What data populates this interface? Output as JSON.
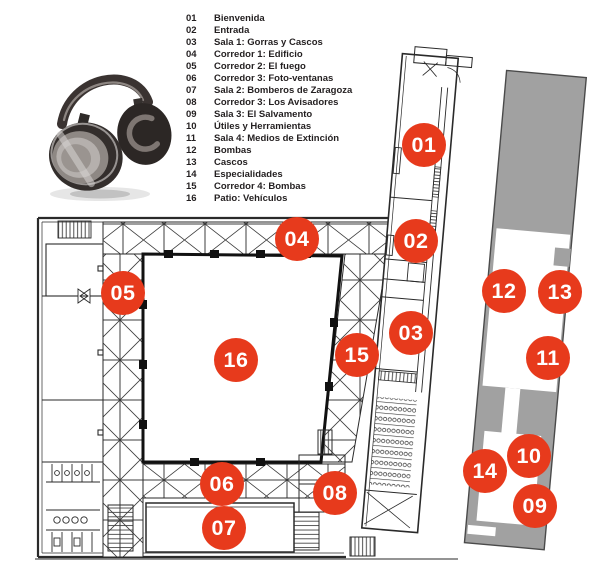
{
  "page": {
    "type": "museum-audioguide-floorplan"
  },
  "legend": {
    "items": [
      {
        "num": "01",
        "label": "Bienvenida"
      },
      {
        "num": "02",
        "label": "Entrada"
      },
      {
        "num": "03",
        "label": "Sala 1: Gorras y Cascos"
      },
      {
        "num": "04",
        "label": "Corredor 1: Edificio"
      },
      {
        "num": "05",
        "label": "Corredor 2: El fuego"
      },
      {
        "num": "06",
        "label": "Corredor 3: Foto-ventanas"
      },
      {
        "num": "07",
        "label": "Sala 2: Bomberos de Zaragoza"
      },
      {
        "num": "08",
        "label": "Corredor 3: Los Avisadores"
      },
      {
        "num": "09",
        "label": "Sala 3: El Salvamento"
      },
      {
        "num": "10",
        "label": "Útiles y Herramientas"
      },
      {
        "num": "11",
        "label": "Sala 4: Medios de Extinción"
      },
      {
        "num": "12",
        "label": "Bombas"
      },
      {
        "num": "13",
        "label": "Cascos"
      },
      {
        "num": "14",
        "label": "Especialidades"
      },
      {
        "num": "15",
        "label": "Corredor 4: Bombas"
      },
      {
        "num": "16",
        "label": "Patio: Vehículos"
      }
    ],
    "text_color": "#231f20"
  },
  "map": {
    "marker_color": "#e73a1c",
    "marker_text_color": "#ffffff",
    "annex_fill": "#a1a1a1",
    "line_color": "#2a2a2a",
    "markers": [
      {
        "num": "01",
        "x": 424,
        "y": 145
      },
      {
        "num": "02",
        "x": 416,
        "y": 241
      },
      {
        "num": "03",
        "x": 411,
        "y": 333
      },
      {
        "num": "04",
        "x": 297,
        "y": 239
      },
      {
        "num": "05",
        "x": 123,
        "y": 293
      },
      {
        "num": "06",
        "x": 222,
        "y": 484
      },
      {
        "num": "07",
        "x": 224,
        "y": 528
      },
      {
        "num": "08",
        "x": 335,
        "y": 493
      },
      {
        "num": "09",
        "x": 535,
        "y": 506
      },
      {
        "num": "10",
        "x": 529,
        "y": 456
      },
      {
        "num": "11",
        "x": 548,
        "y": 358
      },
      {
        "num": "12",
        "x": 504,
        "y": 291
      },
      {
        "num": "13",
        "x": 560,
        "y": 292
      },
      {
        "num": "14",
        "x": 485,
        "y": 471
      },
      {
        "num": "15",
        "x": 357,
        "y": 355
      },
      {
        "num": "16",
        "x": 236,
        "y": 360
      }
    ]
  },
  "icons": {
    "audio_guide": "headphones-icon"
  }
}
